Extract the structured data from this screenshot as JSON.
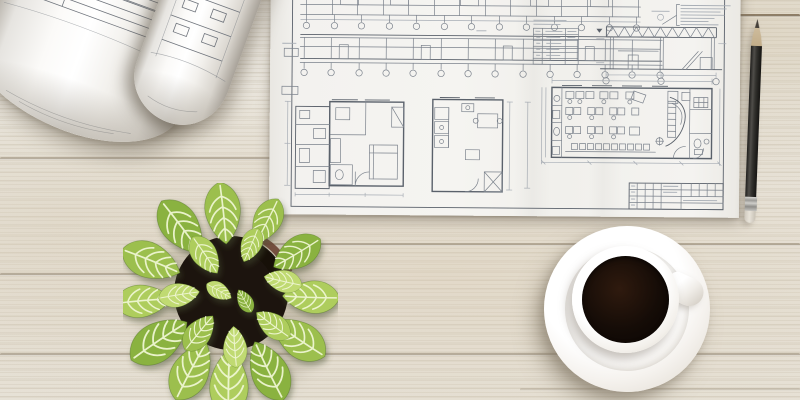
{
  "scene": {
    "title": "Architect workspace, top view",
    "description": "White wooden desk with an open blueprint sheet of floor plans and elevations, two rolled-up blueprints, a potted fittonia plant, a cup of black coffee on a saucer, and a sharpened pencil",
    "objects": [
      {
        "name": "rolled-blueprint-large",
        "position": "top-left"
      },
      {
        "name": "rolled-blueprint-small",
        "position": "top-left, right of large roll"
      },
      {
        "name": "blueprint-sheet",
        "position": "top-center, contains elevations, apartment plans, truss cross-section, office floor plan, schedule table, title block"
      },
      {
        "name": "fittonia-plant-in-pot",
        "position": "bottom-left"
      },
      {
        "name": "coffee-cup-on-saucer",
        "position": "bottom-right of center"
      },
      {
        "name": "pencil",
        "position": "right edge, vertical"
      }
    ],
    "legible_text": "none (blueprint annotations are illegible at this resolution)"
  },
  "colors": {
    "wood-base": "#eae6dd",
    "wood-groove": "#8a7760",
    "paper": "#f4f3f0",
    "ink": "#7b828c",
    "ink-dark": "#5a616b",
    "ink-faint": "#a7adb5",
    "roll-ink": "#6f747c",
    "leaf-vein": "#eef6d2",
    "soil": "#1c140e",
    "pot-rim": "#6b4233",
    "coffee-dark": "#150c07",
    "coffee-crema": "#7a5a38",
    "cup-white": "#fbfaf8"
  },
  "plant": {
    "palette": [
      "#8ab23f",
      "#9cbf4e",
      "#aecd5d",
      "#c0da72"
    ],
    "leaves": [
      [
        100,
        30,
        -6,
        1.2,
        1
      ],
      [
        58,
        44,
        -37,
        1.25,
        0
      ],
      [
        28,
        78,
        -68,
        1.2,
        1
      ],
      [
        20,
        118,
        -95,
        1.1,
        2
      ],
      [
        36,
        158,
        -124,
        1.3,
        0
      ],
      [
        68,
        188,
        -152,
        1.25,
        1
      ],
      [
        106,
        200,
        -179,
        1.3,
        2
      ],
      [
        146,
        188,
        154,
        1.25,
        0
      ],
      [
        176,
        156,
        124,
        1.2,
        1
      ],
      [
        188,
        114,
        92,
        1.1,
        2
      ],
      [
        174,
        70,
        59,
        1.05,
        0
      ],
      [
        144,
        38,
        27,
        0.95,
        1
      ],
      [
        82,
        72,
        -34,
        0.85,
        2
      ],
      [
        56,
        112,
        -99,
        0.8,
        3
      ],
      [
        76,
        150,
        -141,
        0.85,
        1
      ],
      [
        112,
        164,
        176,
        0.8,
        3
      ],
      [
        150,
        142,
        127,
        0.8,
        2
      ],
      [
        160,
        98,
        103,
        0.75,
        3
      ],
      [
        128,
        62,
        23,
        0.7,
        2
      ],
      [
        96,
        108,
        -60,
        0.55,
        3
      ],
      [
        122,
        118,
        150,
        0.5,
        0
      ]
    ]
  }
}
